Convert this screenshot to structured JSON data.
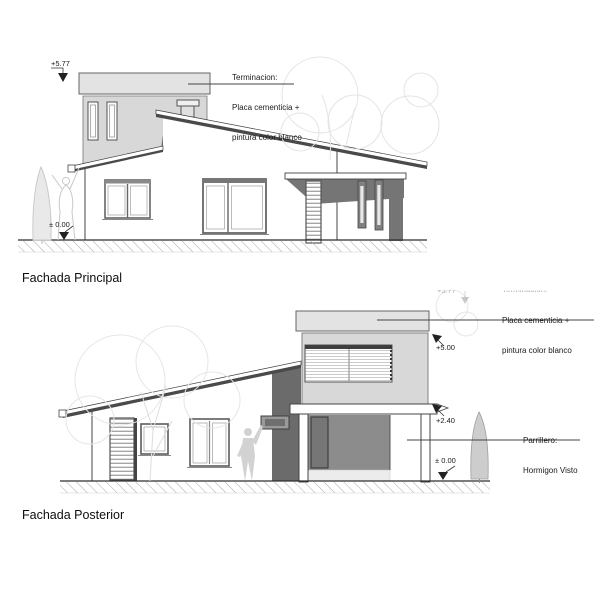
{
  "sheet": {
    "background": "#ffffff"
  },
  "colors": {
    "wall_fill": "#d8d8d8",
    "parapet_fill": "#e3e3e3",
    "shadow_dark": "#6e6e6e",
    "parrillero_fill": "#8c8c8c",
    "drawing_line": "#444444",
    "ground_line": "#2e2e2e",
    "entourage_gray": "#d9d9d9",
    "text": "#1a1a1a"
  },
  "facade_principal": {
    "title": "Fachada Principal",
    "levels": {
      "parapet": "+5.77",
      "ground": "± 0.00"
    },
    "finish_note": {
      "line1": "Terminacion:",
      "line2": "Placa cementicia +",
      "line3": "pintura color blanco"
    }
  },
  "facade_posterior": {
    "title": "Fachada Posterior",
    "levels": {
      "parapet_partial": "+5.77",
      "roof": "+5.00",
      "beam": "+2.40",
      "ground": "± 0.00"
    },
    "finish_note": {
      "line1": "Terminacion:",
      "line2": "Placa cementicia +",
      "line3": "pintura color blanco"
    },
    "grill_note": {
      "line1": "Parrillero:",
      "line2": "Hormigon Visto"
    }
  }
}
